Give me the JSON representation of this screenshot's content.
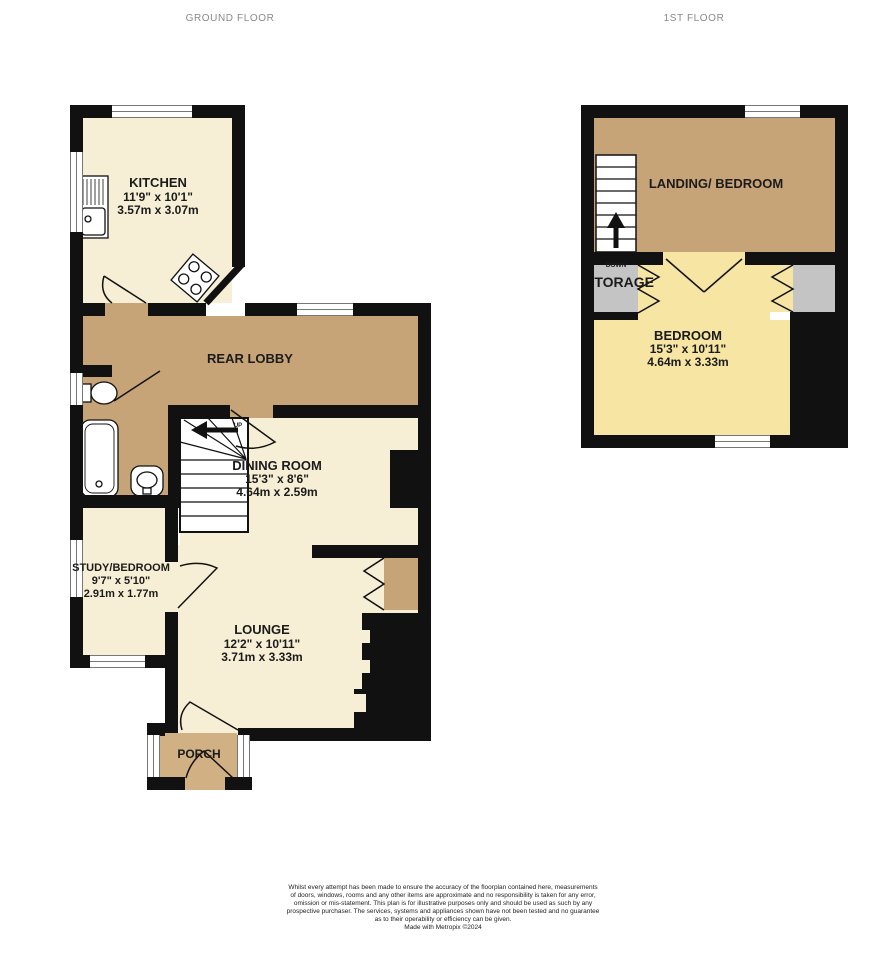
{
  "floor_titles": {
    "ground": "GROUND FLOOR",
    "first": "1ST FLOOR"
  },
  "rooms": {
    "kitchen": {
      "name": "KITCHEN",
      "imperial": "11'9\" x 10'1\"",
      "metric": "3.57m x 3.07m"
    },
    "rear_lobby": {
      "name": "REAR LOBBY"
    },
    "dining_room": {
      "name": "DINING ROOM",
      "imperial": "15'3\" x 8'6\"",
      "metric": "4.64m x 2.59m"
    },
    "study_bedroom": {
      "name": "STUDY/BEDROOM",
      "imperial": "9'7\" x 5'10\"",
      "metric": "2.91m x 1.77m"
    },
    "lounge": {
      "name": "LOUNGE",
      "imperial": "12'2\" x 10'11\"",
      "metric": "3.71m x 3.33m"
    },
    "porch": {
      "name": "PORCH"
    },
    "landing_bedroom": {
      "name": "LANDING/ BEDROOM"
    },
    "storage": {
      "name": "STORAGE"
    },
    "bedroom": {
      "name": "BEDROOM",
      "imperial": "15'3\" x 10'11\"",
      "metric": "4.64m x 3.33m"
    },
    "airing_cupboard": {
      "name": "AIRING CUPBOARD"
    }
  },
  "stair_labels": {
    "up": "UP",
    "down": "DOWN"
  },
  "colors": {
    "room_cream": "#f6efd5",
    "hall_tan": "#c7a477",
    "porch_tan": "#d1b183",
    "bedroom_yellow": "#f6e5a3",
    "cupboard_gray": "#c4c4c4",
    "wall_black": "#111111"
  },
  "disclaimer": {
    "lines": [
      "Whilst every attempt has been made to ensure the accuracy of the floorplan contained here, measurements",
      "of doors, windows, rooms and any other items are approximate and no responsibility is taken for any error,",
      "omission or mis-statement. This plan is for illustrative purposes only and should be used as such by any",
      "prospective purchaser. The services, systems and appliances shown have not been tested and no guarantee",
      "as to their operability or efficiency can be given.",
      "Made with Metropix ©2024"
    ]
  }
}
